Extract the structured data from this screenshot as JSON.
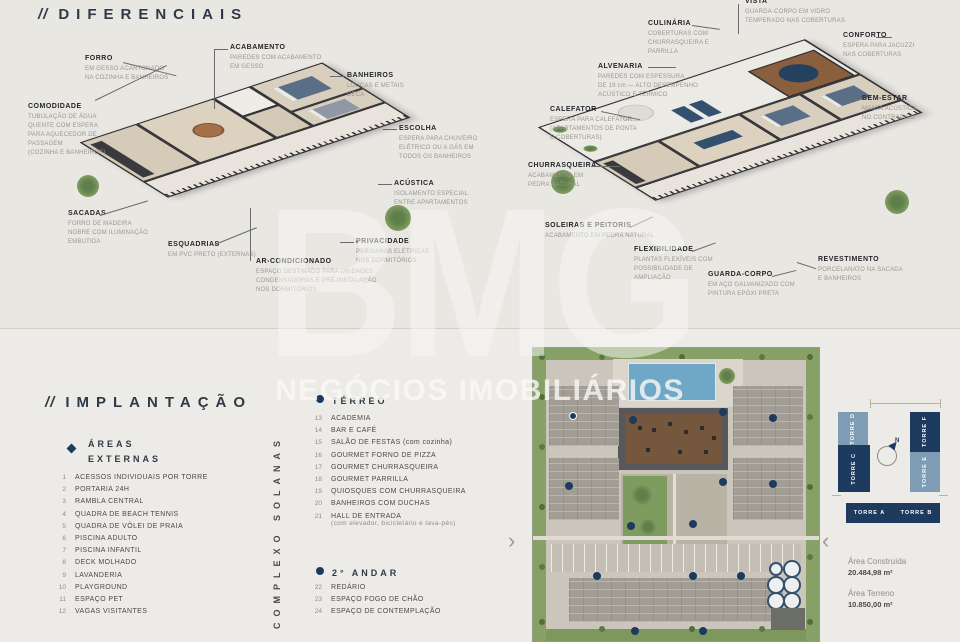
{
  "watermark": {
    "brand": "BMG",
    "tagline": "NEGÓCIOS IMOBILIÁRIOS"
  },
  "colors": {
    "accent_navy": "#1d3a5f",
    "steel_blue": "#7e9cb4",
    "bg_top": "#e9e7e2",
    "bg_bottom": "#edebe7"
  },
  "diferenciais": {
    "title_prefix": "//",
    "title": "DIFERENCIAIS",
    "labels_left": [
      {
        "name": "FORRO",
        "desc": "EM GESSO ACARTONADO\nNA COZINHA E BANHEIROS"
      },
      {
        "name": "ACABAMENTO",
        "desc": "PAREDES COM ACABAMENTO\nEM GESSO"
      },
      {
        "name": "BANHEIROS",
        "desc": "LOUÇAS E METAIS\nDECA"
      },
      {
        "name": "ESCOLHA",
        "desc": "ESPERA PARA CHUVEIRO\nELÉTRICO OU A GÁS EM\nTODOS OS BANHEIROS"
      },
      {
        "name": "ACÚSTICA",
        "desc": "ISOLAMENTO ESPECIAL\nENTRE APARTAMENTOS"
      },
      {
        "name": "PRIVACIDADE",
        "desc": "PERSIANAS ELÉTRICAS\nNOS DORMITÓRIOS"
      },
      {
        "name": "AR-CONDICIONADO",
        "desc": "ESPAÇO DESTINADO PARA UNIDADES\nCONDENSADORAS E PRÉ-INSTALAÇÃO\nNOS DORMITÓRIOS"
      },
      {
        "name": "ESQUADRIAS",
        "desc": "EM PVC PRETO (EXTERNAS)"
      },
      {
        "name": "SACADAS",
        "desc": "FORRO DE MADEIRA\nNOBRE COM ILUMINAÇÃO\nEMBUTIDA"
      },
      {
        "name": "COMODIDADE",
        "desc": "TUBULAÇÃO DE ÁGUA\nQUENTE COM ESPERA\nPARA AQUECEDOR DE\nPASSAGEM\n(COZINHA E BANHEIROS)"
      }
    ],
    "labels_right": [
      {
        "name": "CULINÁRIA",
        "desc": "COBERTURAS COM\nCHURRASQUEIRA E\nPARRILLA"
      },
      {
        "name": "VISTA",
        "desc": "GUARDA-CORPO EM VIDRO\nTEMPERADO NAS COBERTURAS"
      },
      {
        "name": "CONFORTO",
        "desc": "ESPERA PARA JACUZZI\nNAS COBERTURAS"
      },
      {
        "name": "ALVENARIA",
        "desc": "PAREDES COM ESPESSURA\nDE 19 cm — ALTO DESEMPENHO\nACÚSTICO E TÉRMICO"
      },
      {
        "name": "BEM-ESTAR",
        "desc": "MANTA ACÚSTICA\nNO CONTRAPISO"
      },
      {
        "name": "CALEFATOR",
        "desc": "ESPERA PARA CALEFATOR\n(APARTAMENTOS DE PONTA\nE COBERTURAS)"
      },
      {
        "name": "CHURRASQUEIRA",
        "desc": "ACABAMENTO EM\nPEDRA NATURAL"
      },
      {
        "name": "SOLEIRAS E PEITORIS",
        "desc": "ACABAMENTO EM PEDRA NATURAL"
      },
      {
        "name": "FLEXIBILIDADE",
        "desc": "PLANTAS FLEXÍVEIS COM\nPOSSIBILIDADE DE\nAMPLIAÇÃO"
      },
      {
        "name": "GUARDA-CORPO",
        "desc": "EM AÇO GALVANIZADO COM\nPINTURA EPÓXI PRETA"
      },
      {
        "name": "REVESTIMENTO",
        "desc": "PORCELANATO NA SACADA\nE BANHEIROS"
      }
    ]
  },
  "implantacao": {
    "title_prefix": "//",
    "title": "IMPLANTAÇÃO",
    "vertical_label": "COMPLEXO SOLANAS",
    "areas_externas": {
      "heading": "ÁREAS\nEXTERNAS",
      "items": [
        {
          "num": "1",
          "label": "ACESSOS INDIVIDUAIS POR TORRE"
        },
        {
          "num": "2",
          "label": "PORTARIA 24H"
        },
        {
          "num": "3",
          "label": "RAMBLA CENTRAL"
        },
        {
          "num": "4",
          "label": "QUADRA DE BEACH TENNIS"
        },
        {
          "num": "5",
          "label": "QUADRA DE VÔLEI DE PRAIA"
        },
        {
          "num": "6",
          "label": "PISCINA ADULTO"
        },
        {
          "num": "7",
          "label": "PISCINA INFANTIL"
        },
        {
          "num": "8",
          "label": "DECK MOLHADO"
        },
        {
          "num": "9",
          "label": "LAVANDERIA"
        },
        {
          "num": "10",
          "label": "PLAYGROUND"
        },
        {
          "num": "11",
          "label": "ESPAÇO PET"
        },
        {
          "num": "12",
          "label": "VAGAS VISITANTES"
        }
      ]
    },
    "terreo": {
      "heading": "TÉRREO",
      "items": [
        {
          "num": "13",
          "label": "ACADEMIA"
        },
        {
          "num": "14",
          "label": "BAR E CAFÉ"
        },
        {
          "num": "15",
          "label": "SALÃO DE FESTAS (com cozinha)"
        },
        {
          "num": "16",
          "label": "GOURMET FORNO DE PIZZA"
        },
        {
          "num": "17",
          "label": "GOURMET CHURRASQUEIRA"
        },
        {
          "num": "18",
          "label": "GOURMET PARRILLA"
        },
        {
          "num": "19",
          "label": "QUIOSQUES COM CHURRASQUEIRA"
        },
        {
          "num": "20",
          "label": "BANHEIROS COM DUCHAS"
        },
        {
          "num": "21",
          "label": "HALL DE ENTRADA"
        }
      ],
      "hall_note": "(com elevador, bicicletário e lava-pés)"
    },
    "segundo_andar": {
      "heading": "2° ANDAR",
      "items": [
        {
          "num": "22",
          "label": "REDÁRIO"
        },
        {
          "num": "23",
          "label": "ESPAÇO FOGO DE CHÃO"
        },
        {
          "num": "24",
          "label": "ESPAÇO DE CONTEMPLAÇÃO"
        }
      ]
    },
    "carousel": {
      "prev": "‹",
      "next": "›"
    },
    "towers": {
      "a": "TORRE A",
      "b": "TORRE B",
      "c": "TORRE C",
      "d": "TORRE D",
      "e": "TORRE E",
      "f": "TORRE F",
      "compass": "N"
    },
    "areas_info": [
      {
        "label": "Área Construída",
        "value": "20.484,98 m²"
      },
      {
        "label": "Área Terreno",
        "value": "10.850,00 m²"
      }
    ]
  }
}
